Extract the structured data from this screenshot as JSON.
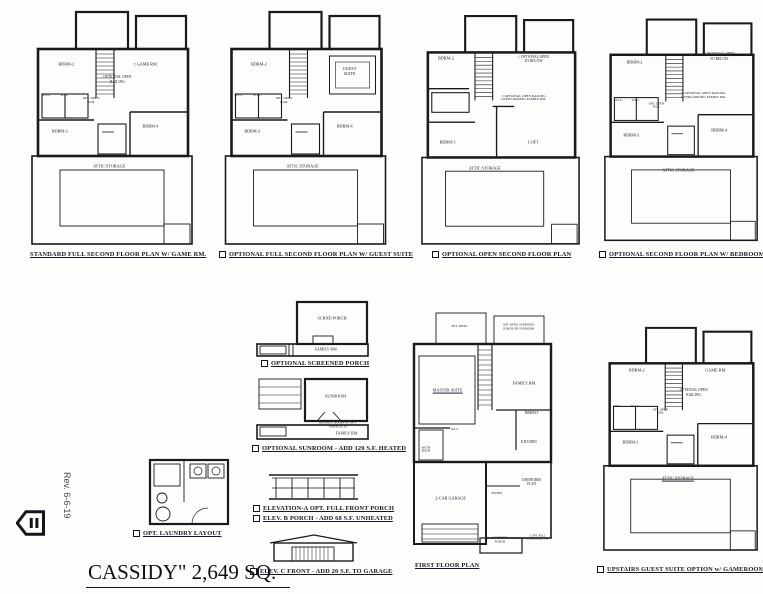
{
  "sheet": {
    "title": "CASSIDY\" 2,649 SQ.",
    "revision": "Rev. 6-6-19",
    "ink_color": "#16161f",
    "paper_color": "#fdfdfc"
  },
  "plans": {
    "standard_second": {
      "caption": "STANDARD FULL SECOND FLOOR PLAN W/ GAME RM.",
      "has_checkbox": false,
      "labels": [
        {
          "t": "BDRM-2",
          "x": 22,
          "y": 24
        },
        {
          "t": "□ GAME RM.",
          "x": 70,
          "y": 24
        },
        {
          "t": "OPTIONAL OPEN RAILING",
          "x": 53,
          "y": 30,
          "w": 34,
          "fs": 3.6
        },
        {
          "t": "OPT. OPEN RAIL",
          "x": 37,
          "y": 39,
          "w": 20,
          "fs": 3.4
        },
        {
          "t": "W.I.C.",
          "x": 10,
          "y": 37,
          "fs": 3.4
        },
        {
          "t": "W.I.C.",
          "x": 21,
          "y": 37,
          "fs": 3.4
        },
        {
          "t": "BDRM-3",
          "x": 18,
          "y": 52
        },
        {
          "t": "BDRM-4",
          "x": 73,
          "y": 50
        },
        {
          "t": "ATTIC STORAGE",
          "x": 48,
          "y": 67
        }
      ]
    },
    "guest_suite_second": {
      "caption": "OPTIONAL FULL SECOND FLOOR PLAN W/ GUEST SUITE",
      "has_checkbox": true,
      "labels": [
        {
          "t": "BDRM-2",
          "x": 22,
          "y": 24
        },
        {
          "t": "GUEST SUITE",
          "x": 76,
          "y": 27,
          "w": 26
        },
        {
          "t": "OPT. OPEN RAIL",
          "x": 37,
          "y": 39,
          "w": 20,
          "fs": 3.4
        },
        {
          "t": "W.I.C.",
          "x": 10,
          "y": 37,
          "fs": 3.4
        },
        {
          "t": "W.I.C.",
          "x": 21,
          "y": 37,
          "fs": 3.4
        },
        {
          "t": "BDRM-3",
          "x": 18,
          "y": 52
        },
        {
          "t": "BDRM-4",
          "x": 73,
          "y": 50
        },
        {
          "t": "ATTIC STORAGE",
          "x": 48,
          "y": 67
        }
      ]
    },
    "open_second": {
      "caption": "OPTIONAL OPEN SECOND FLOOR PLAN",
      "has_checkbox": true,
      "labels": [
        {
          "t": "BDRM-2",
          "x": 16,
          "y": 20
        },
        {
          "t": "□ OPTIONAL OPEN TO BELOW",
          "x": 70,
          "y": 20,
          "w": 34,
          "fs": 3.6
        },
        {
          "t": "□ OPTIONAL OPEN RAILING OVERLOOKING FAMILY RM.",
          "x": 64,
          "y": 37,
          "w": 62,
          "fs": 3.4
        },
        {
          "t": "BDRM-3",
          "x": 17,
          "y": 56
        },
        {
          "t": "LOFT",
          "x": 70,
          "y": 56
        },
        {
          "t": "ATTIC STORAGE",
          "x": 40,
          "y": 67
        }
      ]
    },
    "bedroom4_second": {
      "caption": "OPTIONAL SECOND FLOOR PLAN W/ BEDROOM-4",
      "has_checkbox": true,
      "labels": [
        {
          "t": "BDRM-2",
          "x": 20,
          "y": 22
        },
        {
          "t": "□ OPTIONAL OPEN TO BELOW",
          "x": 74,
          "y": 19,
          "w": 32,
          "fs": 3.6
        },
        {
          "t": "□ OPTIONAL OPEN RAILING OVERLOOKING FAMILY RM.",
          "x": 64,
          "y": 36,
          "w": 62,
          "fs": 3.4
        },
        {
          "t": "OPT. OPEN RAIL",
          "x": 34,
          "y": 40,
          "w": 20,
          "fs": 3.2
        },
        {
          "t": "W.I.C.",
          "x": 10,
          "y": 38,
          "fs": 3.4
        },
        {
          "t": "W.I.C.",
          "x": 21,
          "y": 38,
          "fs": 3.4
        },
        {
          "t": "BDRM-3",
          "x": 18,
          "y": 53
        },
        {
          "t": "BDRM-4",
          "x": 74,
          "y": 51
        },
        {
          "t": "ATTIC STORAGE",
          "x": 48,
          "y": 68
        }
      ]
    },
    "screened_porch": {
      "caption": "OPTIONAL SCREENED PORCH",
      "has_checkbox": true,
      "labels": [
        {
          "t": "SCRND PORCH",
          "x": 67,
          "y": 33,
          "w": 30
        },
        {
          "t": "FAMILY RM.",
          "x": 62,
          "y": 86,
          "fs": 4
        }
      ]
    },
    "sunroom": {
      "caption": "OPTIONAL SUNROOM - ADD 120 S.F. HEATED",
      "has_checkbox": true,
      "labels": [
        {
          "t": "SUNROOM",
          "x": 70,
          "y": 33
        },
        {
          "t": "(DOUBLE DOORS W/ OPT. FIREPLACE)",
          "x": 72,
          "y": 76,
          "w": 52,
          "fs": 3.2
        },
        {
          "t": "FAMILY RM.",
          "x": 80,
          "y": 90,
          "fs": 4
        }
      ]
    },
    "laundry": {
      "caption": "OPT. LAUNDRY LAYOUT",
      "has_checkbox": true,
      "labels": []
    },
    "elev_a": {
      "caption": "ELEVATION-A OPT. FULL FRONT PORCH",
      "has_checkbox": true
    },
    "elev_b": {
      "caption": "ELEV. B PORCH - ADD 68 S.F. UNHEATED",
      "has_checkbox": true
    },
    "elev_c": {
      "caption": "ELEV. C FRONT - ADD 20 S.F. TO GARAGE",
      "has_checkbox": true
    },
    "first_floor": {
      "caption": "FIRST FLOOR PLAN",
      "has_checkbox": false,
      "labels": [
        {
          "t": "OPT. PATIO",
          "x": 34,
          "y": 7,
          "fs": 3.2,
          "w": 30
        },
        {
          "t": "OPT. PATIO SCREENED PORCH OR SUNROOM",
          "x": 75,
          "y": 7,
          "fs": 3,
          "w": 40
        },
        {
          "t": "MASTER SUITE",
          "x": 26,
          "y": 33,
          "u": true
        },
        {
          "t": "FAMILY RM.",
          "x": 79,
          "y": 30
        },
        {
          "t": "W.I.C.",
          "x": 31,
          "y": 49,
          "fs": 3.4
        },
        {
          "t": "MSTR BATH",
          "x": 11,
          "y": 57,
          "fs": 3.2,
          "w": 16
        },
        {
          "t": "BRKFST",
          "x": 84,
          "y": 42,
          "fs": 3.6
        },
        {
          "t": "KITCHEN",
          "x": 82,
          "y": 54,
          "fs": 3.6
        },
        {
          "t": "2-CAR GARAGE",
          "x": 28,
          "y": 77
        },
        {
          "t": "ENTRY",
          "x": 60,
          "y": 75,
          "fs": 3.4
        },
        {
          "t": "DININGRM/ FLEX",
          "x": 84,
          "y": 70,
          "w": 26,
          "fs": 3.6
        },
        {
          "t": "COVERED PORCH",
          "x": 62,
          "y": 94,
          "fs": 3.2,
          "w": 22
        },
        {
          "t": "□ OPT. FULL PORCH ELEV. A",
          "x": 88,
          "y": 93,
          "fs": 3,
          "w": 26
        }
      ]
    },
    "gameroom_guest": {
      "caption": "UPSTAIRS GUEST SUITE OPTION w/ GAMEROOM",
      "has_checkbox": true,
      "labels": [
        {
          "t": "BDRM-2",
          "x": 22,
          "y": 22
        },
        {
          "t": "GAME RM.",
          "x": 72,
          "y": 22
        },
        {
          "t": "OPTIONAL OPEN RAILING",
          "x": 58,
          "y": 31,
          "w": 36,
          "fs": 3.6
        },
        {
          "t": "OPT. OPEN RAIL",
          "x": 37,
          "y": 39,
          "w": 20,
          "fs": 3.2
        },
        {
          "t": "W.I.C.",
          "x": 10,
          "y": 37,
          "fs": 3.4
        },
        {
          "t": "W.I.C.",
          "x": 21,
          "y": 37,
          "fs": 3.4
        },
        {
          "t": "BDRM-3",
          "x": 18,
          "y": 52
        },
        {
          "t": "BDRM-4",
          "x": 74,
          "y": 50
        },
        {
          "t": "ATTIC STORAGE",
          "x": 48,
          "y": 67,
          "u": true
        }
      ]
    }
  }
}
